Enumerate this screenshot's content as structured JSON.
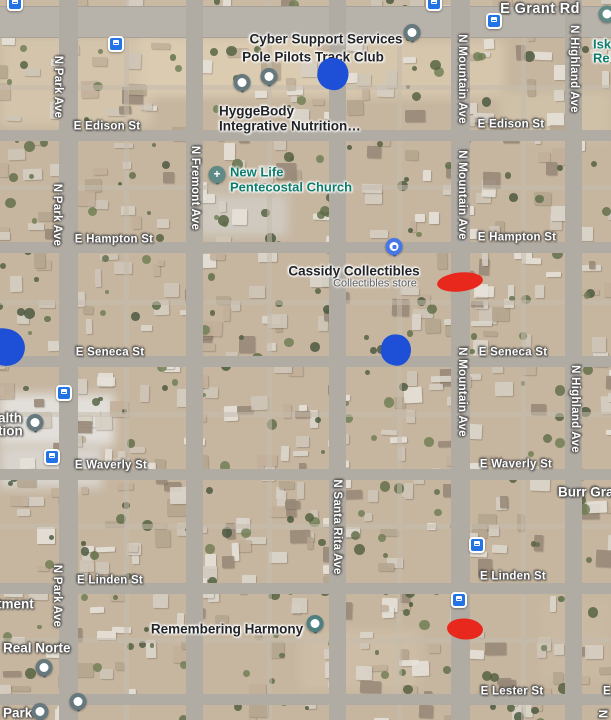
{
  "map": {
    "type_label": "satellite-map-view",
    "colors": {
      "blue_marker": "#1d4fd7",
      "red_marker": "#e8271d",
      "bus_icon_blue": "#2273e6",
      "teal_poi_text": "#0c7d6c",
      "pin_gray": "#66797f",
      "pin_teal_church": "#5f8a86",
      "pin_teal_memorial": "#4e7f81",
      "pin_blue_shopping": "#4776e6"
    },
    "street_labels_h": [
      {
        "text": "E Grant Rd",
        "x": 540,
        "y": 9,
        "major": true
      },
      {
        "text": "E Edison St",
        "x": 107,
        "y": 127
      },
      {
        "text": "E Edison St",
        "x": 511,
        "y": 125
      },
      {
        "text": "E Hampton St",
        "x": 114,
        "y": 240
      },
      {
        "text": "E Hampton St",
        "x": 517,
        "y": 238
      },
      {
        "text": "E Seneca St",
        "x": 110,
        "y": 353
      },
      {
        "text": "E Seneca St",
        "x": 513,
        "y": 353
      },
      {
        "text": "E Waverly St",
        "x": 111,
        "y": 466
      },
      {
        "text": "E Waverly St",
        "x": 516,
        "y": 465
      },
      {
        "text": "E Linden St",
        "x": 110,
        "y": 581
      },
      {
        "text": "E Linden St",
        "x": 513,
        "y": 577
      },
      {
        "text": "E Lester St",
        "x": 512,
        "y": 692
      },
      {
        "text": "E",
        "x": 607,
        "y": 692
      }
    ],
    "street_labels_v": [
      {
        "text": "N Park Ave",
        "x": 57,
        "y": 87
      },
      {
        "text": "N Park Ave",
        "x": 56,
        "y": 215
      },
      {
        "text": "N Park Ave",
        "x": 56,
        "y": 596
      },
      {
        "text": "N Fremont Ave",
        "x": 194,
        "y": 188
      },
      {
        "text": "N Santa Rita Ave",
        "x": 336,
        "y": 527
      },
      {
        "text": "N Mountain Ave",
        "x": 461,
        "y": 79
      },
      {
        "text": "N Mountain Ave",
        "x": 461,
        "y": 195
      },
      {
        "text": "N Mountain Ave",
        "x": 461,
        "y": 392
      },
      {
        "text": "N Highland Ave",
        "x": 573,
        "y": 69
      },
      {
        "text": "N Highland Ave",
        "x": 574,
        "y": 409
      },
      {
        "text": "N",
        "x": 601,
        "y": 714
      }
    ],
    "poi_labels": [
      {
        "text": "Cyber Support Services",
        "style": "dark",
        "x": 326,
        "y": 39
      },
      {
        "text": "Pole Pilots Track Club",
        "style": "dark",
        "x": 313,
        "y": 57
      },
      {
        "text": "HyggeBody",
        "style": "dark",
        "x": 219,
        "y": 111,
        "align": "left"
      },
      {
        "text": "Integrative Nutrition…",
        "style": "dark",
        "x": 219,
        "y": 126,
        "align": "left"
      },
      {
        "text": "New Life",
        "style": "teal",
        "x": 230,
        "y": 172,
        "align": "left"
      },
      {
        "text": "Pentecostal Church",
        "style": "teal",
        "x": 230,
        "y": 187,
        "align": "left"
      },
      {
        "text": "Cassidy Collectibles",
        "style": "dark",
        "x": 354,
        "y": 271
      },
      {
        "text": "Collectibles store",
        "style": "sub",
        "x": 375,
        "y": 284
      },
      {
        "text": "Remembering Harmony",
        "style": "dark",
        "x": 227,
        "y": 629
      },
      {
        "text": "Isk",
        "style": "teal",
        "x": 593,
        "y": 44,
        "align": "left"
      },
      {
        "text": "Re",
        "style": "teal",
        "x": 593,
        "y": 58,
        "align": "left"
      },
      {
        "text": "alth",
        "style": "white",
        "x": -2,
        "y": 418,
        "align": "left"
      },
      {
        "text": "tion",
        "style": "white",
        "x": -2,
        "y": 431,
        "align": "left"
      },
      {
        "text": "tment",
        "style": "white",
        "x": -3,
        "y": 604,
        "align": "left"
      },
      {
        "text": "Real Norte",
        "style": "white",
        "x": 3,
        "y": 648,
        "align": "left"
      },
      {
        "text": "Park",
        "style": "white",
        "x": 3,
        "y": 713,
        "align": "left"
      },
      {
        "text": "Burr Grap",
        "style": "white",
        "x": 558,
        "y": 492,
        "align": "left"
      }
    ],
    "pins": [
      {
        "type": "default",
        "name": "poi-pin",
        "x": 412,
        "y": 33
      },
      {
        "type": "default",
        "name": "poi-pin",
        "x": 269,
        "y": 77
      },
      {
        "type": "default",
        "name": "poi-pin",
        "x": 242,
        "y": 83
      },
      {
        "type": "church",
        "name": "church-pin",
        "x": 217,
        "y": 175
      },
      {
        "type": "shopping",
        "name": "shopping-pin",
        "x": 394,
        "y": 247
      },
      {
        "type": "default",
        "name": "poi-pin",
        "x": 35,
        "y": 423
      },
      {
        "type": "memorial",
        "name": "memorial-pin",
        "x": 315,
        "y": 624
      },
      {
        "type": "default",
        "name": "poi-pin",
        "x": 44,
        "y": 668
      },
      {
        "type": "default",
        "name": "poi-pin",
        "x": 78,
        "y": 702
      },
      {
        "type": "default",
        "name": "poi-pin",
        "x": 40,
        "y": 712
      },
      {
        "type": "dot",
        "name": "poi-dot-pin",
        "x": 607,
        "y": 14
      }
    ],
    "bus_stops": [
      {
        "x": 15,
        "y": 3
      },
      {
        "x": 434,
        "y": 3
      },
      {
        "x": 494,
        "y": 21
      },
      {
        "x": 116,
        "y": 44
      },
      {
        "x": 64,
        "y": 393
      },
      {
        "x": 52,
        "y": 457
      },
      {
        "x": 477,
        "y": 545
      },
      {
        "x": 459,
        "y": 600
      }
    ],
    "blue_markers": [
      {
        "x": 333,
        "y": 74,
        "w": 31,
        "h": 32
      },
      {
        "x": 396,
        "y": 350,
        "w": 30,
        "h": 31
      },
      {
        "x": 4,
        "y": 347,
        "w": 42,
        "h": 37
      }
    ],
    "red_markers": [
      {
        "x": 460,
        "y": 282,
        "w": 46,
        "h": 19,
        "rot": -6
      },
      {
        "x": 465,
        "y": 629,
        "w": 36,
        "h": 21,
        "rot": 4
      }
    ]
  }
}
